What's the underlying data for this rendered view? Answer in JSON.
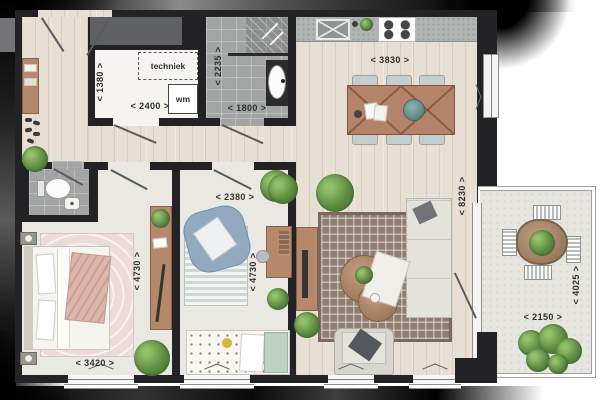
{
  "plan_title": "apartment-floor-plan",
  "rooms": {
    "technical": {
      "label": "techniek",
      "washer_label": "wm",
      "width_dim": "< 2400 >",
      "height_dim": "< 1380 >"
    },
    "bathroom": {
      "width_dim": "< 1800 >",
      "height_dim": "< 2235 >"
    },
    "kitchen": {
      "width_dim": "< 3830 >"
    },
    "living": {
      "height_dim": "< 8230 >"
    },
    "bedroom1": {
      "width_dim": "< 3420 >",
      "height_dim": "< 4730 >"
    },
    "bedroom2": {
      "width_dim": "< 2380 >",
      "height_dim": "< 4730 >"
    },
    "balcony": {
      "width_dim": "< 2150 >",
      "height_dim": "< 4025 >"
    }
  },
  "colors": {
    "wall": "#232325",
    "wood_floor": "#e7dfd3",
    "tile_floor": "#a3a5a4",
    "bedroom_floor": "#e9e8e2",
    "balcony_floor": "#e6e5e0",
    "furniture_wood": "#b5886a",
    "teal_accent": "#6f9f9b",
    "living_rug": "#8f7d72",
    "pink_rug": "#ecdcd8",
    "plant_green": "#5c8a41"
  }
}
